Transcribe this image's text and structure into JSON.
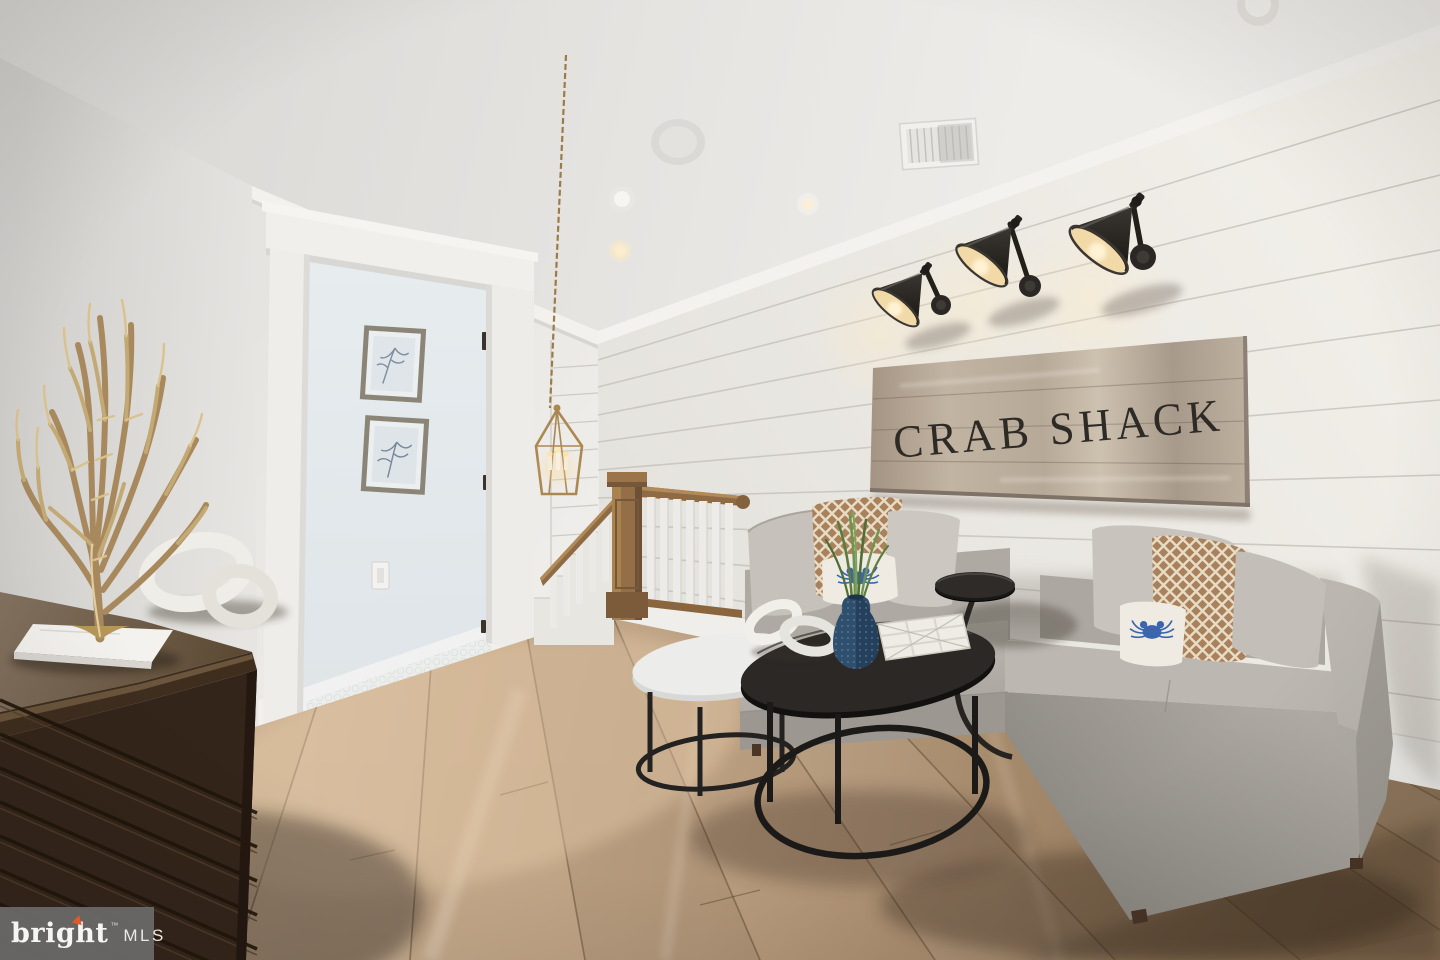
{
  "sign": {
    "text": "CRAB SHACK",
    "board_color": "#b3a596",
    "text_color": "#2e2a26"
  },
  "watermark": {
    "brand": "bright",
    "trademark": "™",
    "suffix": "MLS",
    "background": "#6a6a6a",
    "accent": "#e05a28",
    "text_color": "#f5f5f3"
  },
  "palette": {
    "ceiling": "#e6e4e1",
    "wall_left": "#d8d6d3",
    "wall_shiplap": "#edebe6",
    "shiplap_line": "#c7c4be",
    "hallway": "#e9edef",
    "floor_wood": "#b89c7e",
    "sofa_fabric": "#b4b0a9",
    "pillow_weave": "#a9815d",
    "crab_blue": "#3b66ad",
    "dresser_wood": "#33241a",
    "railing_wood": "#8f6b45",
    "lantern_gold": "#ab8852",
    "coral_gold": "#b8995f",
    "sconce_black": "#292623",
    "sconce_glow": "#f2d9a8",
    "vase_navy": "#2f4f6e"
  },
  "scene_objects": {
    "sconce_count": 3,
    "framed_prints_count": 2,
    "nesting_tables_count": 2
  }
}
